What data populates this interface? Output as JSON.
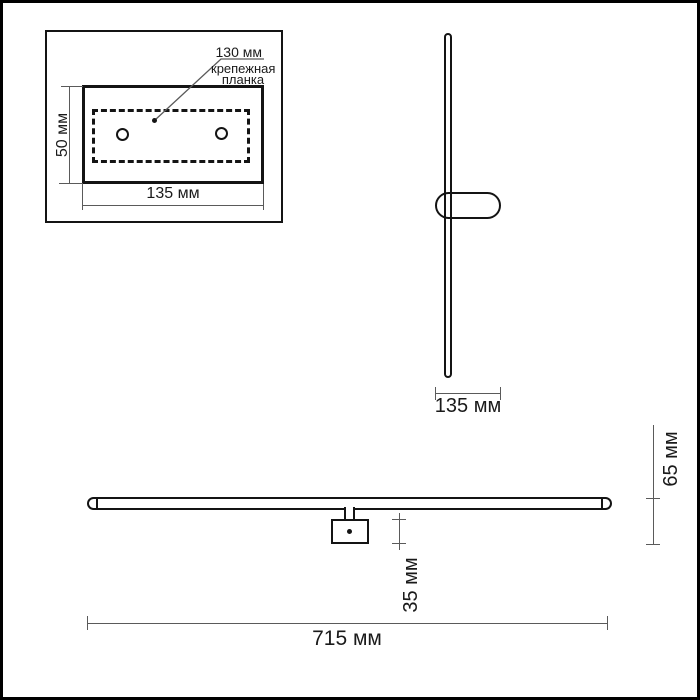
{
  "page": {
    "background": "#ffffff",
    "frame_color": "#000000"
  },
  "colors": {
    "outline": "#141414",
    "dim_line": "#5a5a5a",
    "text": "#1a1a1a"
  },
  "inset": {
    "callout_value": "130 мм",
    "callout_label": "крепежная планка",
    "height_label": "50 мм",
    "width_label": "135 мм"
  },
  "side_view": {
    "width_label": "135 мм"
  },
  "front_view": {
    "bracket_depth_label": "35 мм",
    "total_depth_label": "65 мм",
    "length_label": "715 мм"
  }
}
